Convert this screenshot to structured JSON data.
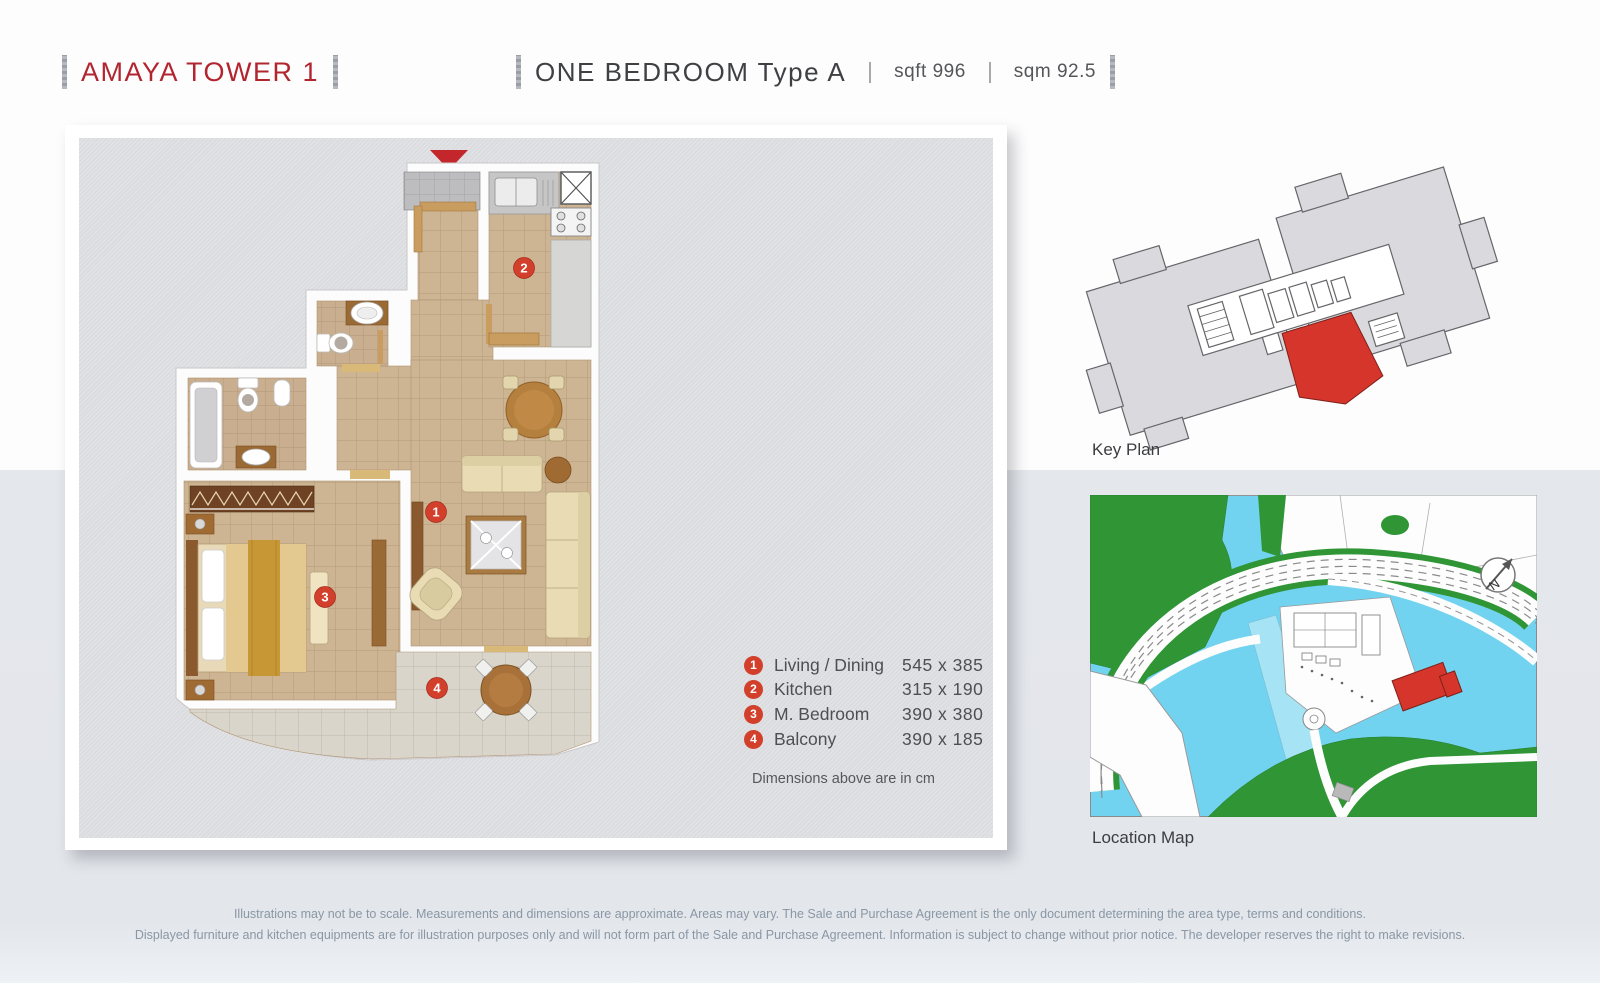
{
  "header": {
    "tower": "AMAYA TOWER 1",
    "unit_type": "ONE BEDROOM Type A",
    "area_sqft": "sqft 996",
    "area_sqm": "sqm 92.5"
  },
  "legend": {
    "items": [
      {
        "num": "1",
        "name": "Living / Dining",
        "dims": "545 x 385"
      },
      {
        "num": "2",
        "name": "Kitchen",
        "dims": "315 x 190"
      },
      {
        "num": "3",
        "name": "M. Bedroom",
        "dims": "390 x 380"
      },
      {
        "num": "4",
        "name": "Balcony",
        "dims": "390 x 185"
      }
    ],
    "note": "Dimensions above are in cm"
  },
  "key_plan": {
    "label": "Key Plan"
  },
  "location_map": {
    "label": "Location Map",
    "compass": "N"
  },
  "disclaimer": {
    "line1": "Illustrations may not be to scale.  Measurements and dimensions are approximate. Areas may vary. The Sale and Purchase Agreement is the only document determining the area type, terms and conditions.",
    "line2": "Displayed furniture and kitchen equipments are for illustration purposes only and will not form part of the Sale and Purchase Agreement. Information is subject to change without prior notice. The developer reserves the right to make revisions."
  },
  "colors": {
    "accent_red": "#b2252f",
    "marker_red": "#d2402c",
    "map_green": "#2f9535",
    "water_cyan": "#72d3f0",
    "highlight_red": "#d6352b"
  }
}
